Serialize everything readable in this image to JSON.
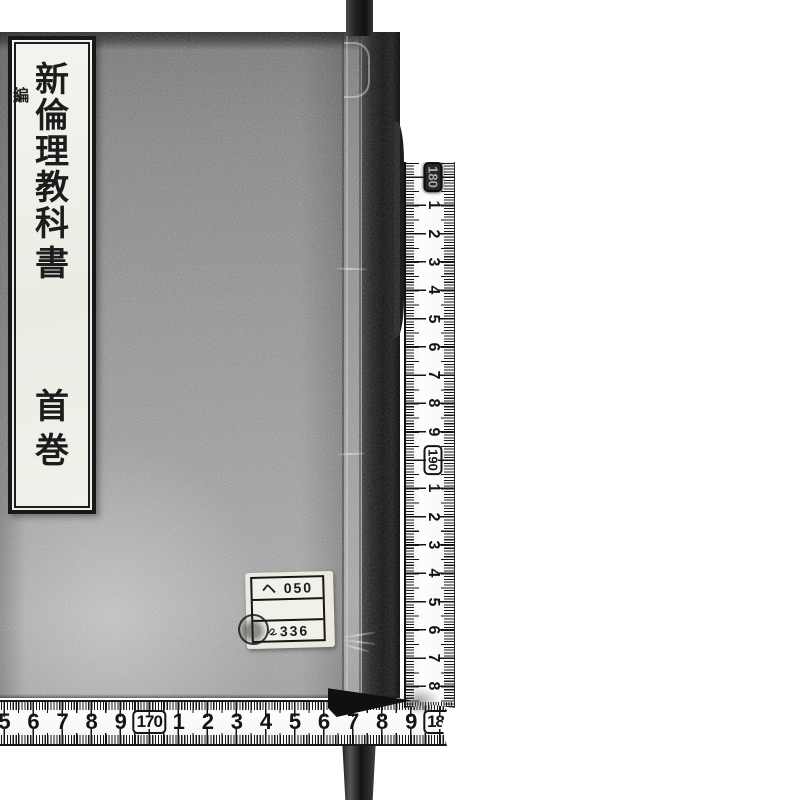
{
  "scene": {
    "description": "Scanned photograph of a traditionally stab-bound Japanese book cover with white measuring tapes along the right edge and bottom",
    "background_color": "#ffffff"
  },
  "book": {
    "title_label": {
      "chars_main": [
        "新",
        "倫",
        "理",
        "教",
        "科",
        "書"
      ],
      "char_small_inline": "編",
      "chars_volume": [
        "首",
        "巻"
      ],
      "reading": "新編倫理教科書 首巻"
    },
    "call_number_label": {
      "row_top": "ヘ 050",
      "row_middle": "",
      "row_bottom": "336",
      "stamp": "circular-ink-stamp"
    }
  },
  "rulers": {
    "vertical": {
      "unit": "cm",
      "sequence": [
        {
          "label": "180",
          "boxed": true,
          "smudged": true
        },
        {
          "label": "1"
        },
        {
          "label": "2"
        },
        {
          "label": "3"
        },
        {
          "label": "4"
        },
        {
          "label": "5"
        },
        {
          "label": "6"
        },
        {
          "label": "7"
        },
        {
          "label": "8"
        },
        {
          "label": "9"
        },
        {
          "label": "190",
          "boxed": true
        },
        {
          "label": "1"
        },
        {
          "label": "2"
        },
        {
          "label": "3"
        },
        {
          "label": "4"
        },
        {
          "label": "5"
        },
        {
          "label": "6"
        },
        {
          "label": "7"
        },
        {
          "label": "8"
        }
      ]
    },
    "horizontal": {
      "unit": "cm",
      "sequence": [
        {
          "label": "5"
        },
        {
          "label": "6"
        },
        {
          "label": "7"
        },
        {
          "label": "8"
        },
        {
          "label": "9"
        },
        {
          "label": "170",
          "boxed": true
        },
        {
          "label": "1"
        },
        {
          "label": "2"
        },
        {
          "label": "3"
        },
        {
          "label": "4"
        },
        {
          "label": "5"
        },
        {
          "label": "6"
        },
        {
          "label": "7"
        },
        {
          "label": "8"
        },
        {
          "label": "9"
        },
        {
          "label": "180",
          "boxed": true
        }
      ]
    }
  },
  "colors": {
    "ink": "#141414",
    "ruler_paper": "#fbfbfa",
    "cover_mid": "#8f8f8f",
    "spine_dark": "#141414",
    "label_paper": "#f2f1ea"
  }
}
